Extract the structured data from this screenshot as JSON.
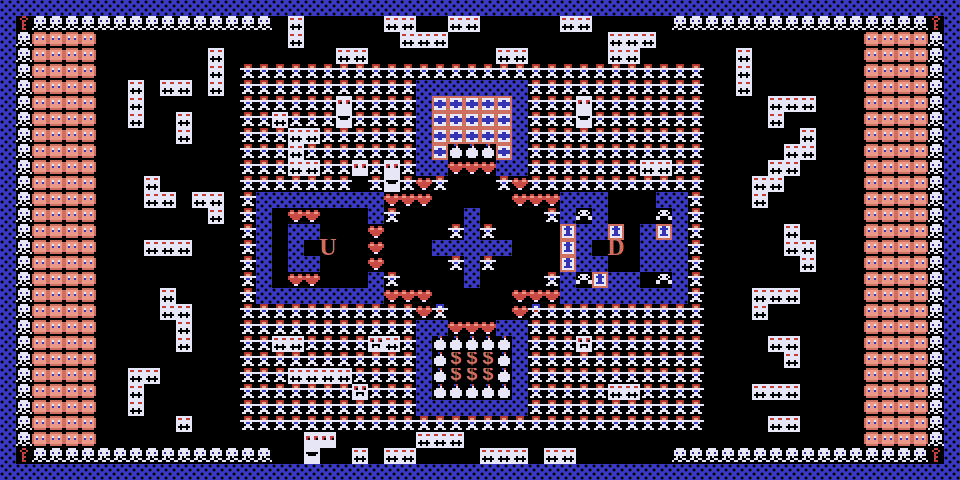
{
  "game": {
    "grid": {
      "cols": 60,
      "rows": 30,
      "tile_size": 16
    },
    "glyphs": {
      "U": "U",
      "D": "D",
      "$": "$"
    },
    "colors": {
      "background": "#000000",
      "wall_blue": "#3a3ac4",
      "sprite_white": "#e6e6f6",
      "enemy_red": "#b03830",
      "face_pink": "#eb9a8a",
      "salmon": "#cf6f5f",
      "heart_red": "#c94b44",
      "cross_blue": "#3434b4",
      "key_red": "#c04040"
    },
    "legend": {
      "#": "wall-tile",
      "S": "skull-tile",
      "k": "small-skull-tile",
      "F": "face-enemy",
      "K": "key-item",
      "H": "creature",
      "I": "creature-blue",
      "d": "critter",
      "e": "critter-eyes",
      "m": "critter-mouth",
      "f": "critter-face",
      "X": "cross-bonus",
      "P": "cake-item",
      "h": "heart-item",
      "U": "stairs-up-letter",
      "D": "stairs-down-letter",
      "$": "money-tile",
      "T": "door-item",
      ".": "floor"
    },
    "tilemap": [
      "############################################################",
      "#KSSSSSSSSSSSSSSS.d.....dd..dd.....dd.....SSSSSSSSSSSSSSSSK#",
      "#SFFFF............d......ddd..........ddd.............FFFFS#",
      "#SFFFF.......d.......dd........dd.....dd......d.......FFFFS#",
      "#SFFFF.......d.HHHHHHHHHHHHHHHHHHHHHHHHHHHHH..d.......FFFFS#",
      "#SFFFF..d.dd.d.HHHHHHHHHHH#######HHHHHHHHHHH..d.......FFFFS#",
      "#SFFFF..d......HHHHHHeHHHH#XXXXX#HHHeHHHHHHH....ddd...FFFFS#",
      "#SFFFF..d..d...HHdHHHmHHHH#XXXXX#HHHmHHHHHHH....d.....FFFFS#",
      "#SFFFF.....d...HHHddHHHHHH#XXXXX#HHHHHHHHHHH......d...FFFFS#",
      "#SFFFF.........HHHdHHHHHHH#XPPPX#HHHHHHHHHHH.....dd...FFFFS#",
      "#SFFFF.........HHHddHHeHeH##hhh##HHHHHHHddHH....dd....FFFFS#",
      "#SFFFF...d.....HHHHHHH.HmHhH...HhHHHHHHHHHHH...dd.....FFFFS#",
      "#SFFFF...dd.dd.H########hhh.....hhh###...##H...d......FFFFS#",
      "#SFFFF.......d.H#.hh...#H....#....H#k#...k#H..........FFFFS#",
      "#SFFFF.........H#.##...h....H#H....T##T.#T#H.....d....FFFFS#",
      "#SFFFF...ddd...H#.#.U..h...#####...T#.D.###H.....dd...FFFFS#",
      "#SFFFF.........H#.##...h....H#H....T##..###H......d...FFFFS#",
      "#SFFFF.........H#.hh...#H....#....H#kT##.k#H..........FFFFS#",
      "#SFFFF....d....H########hhh.....hhh########H...ddd....FFFFS#",
      "#SFFFF....dd...HHHHHHHHHHHhI....hIHHHHHHHHHH...d......FFFFS#",
      "#SFFFF.....d...HHHHHHHHHHH##hhh##HHHHHHHHHHH..........FFFFS#",
      "#SFFFF.....d...HHddHHHHfdH#PPPPP#HHHfHHHHHHH....dd....FFFFS#",
      "#SFFFF.........HHHHHHHHHHH#P$$$P#HHHHHHHHHHH.....d....FFFFS#",
      "#SFFFF..dd.....HHHddddHHHH#P$$$P#HHHHHHHHHHH..........FFFFS#",
      "#SFFFF..d......HHHHHHHfHHH#PPPPP#HHHHHddHHHH...ddd....FFFFS#",
      "#SFFFF..d......HHHHHHHHHHH#######HHHHHHHHHHH..........FFFFS#",
      "#SFFFF.....d...HHHHHHHHHHHHHHHHHHHHHHHHHHHHH....dd....FFFFS#",
      "#SFFFF.............ee.....ddd.........................FFFFS#",
      "#KSSSSSSSSSSSSSSS..m..d.dd....ddd.dd......SSSSSSSSSSSSSSSSK#",
      "############################################################"
    ]
  }
}
